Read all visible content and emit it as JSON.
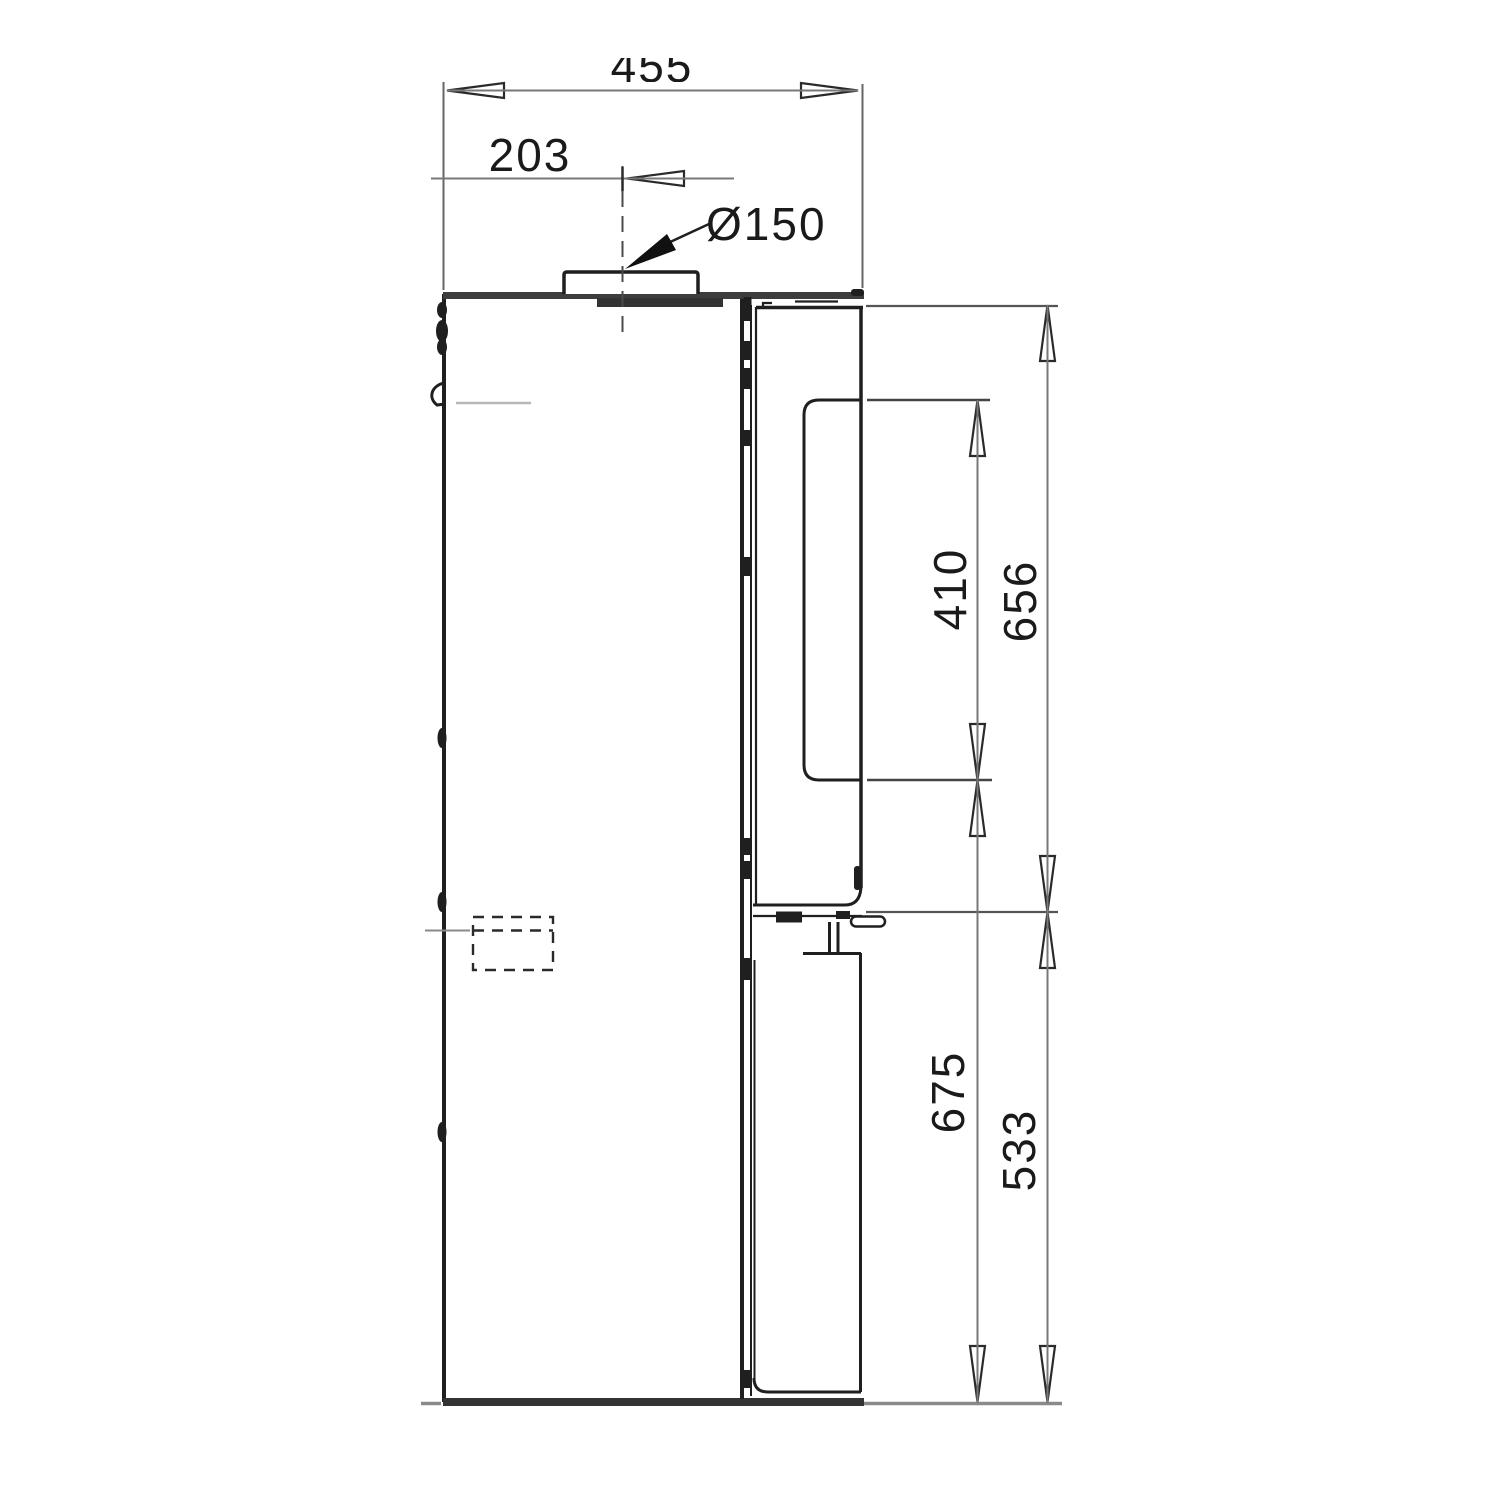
{
  "drawing": {
    "labels": {
      "top_width": "455",
      "flue_offset": "203",
      "flue_diameter": "Ø150",
      "glass_height": "410",
      "upper_height": "656",
      "glass_to_floor": "675",
      "lower_height": "533"
    }
  }
}
